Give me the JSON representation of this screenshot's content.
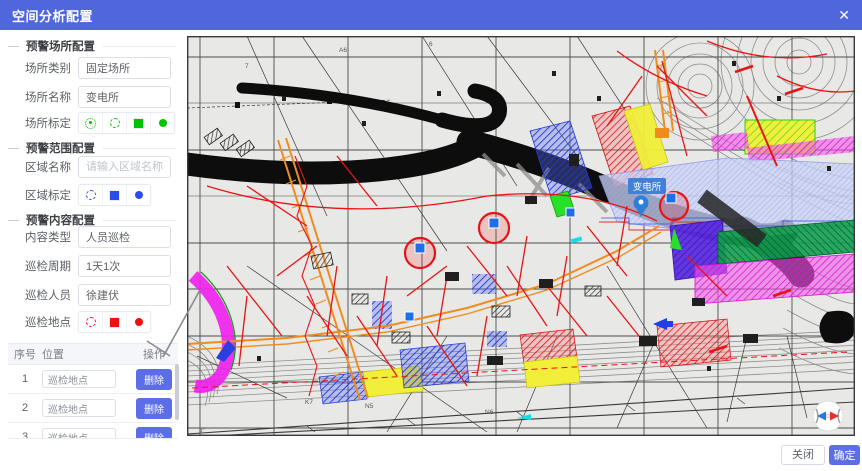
{
  "header": {
    "title": "空间分析配置",
    "close_icon": "✕"
  },
  "panel": {
    "sections": [
      {
        "title": "预警场所配置"
      },
      {
        "title": "预警范围配置"
      },
      {
        "title": "预警内容配置"
      }
    ],
    "fields": {
      "place_type": {
        "label": "场所类别",
        "value": "固定场所"
      },
      "place_name": {
        "label": "场所名称",
        "value": "变电所"
      },
      "place_mark": {
        "label": "场所标定"
      },
      "area_name": {
        "label": "区域名称",
        "placeholder": "请输入区域名称"
      },
      "area_mark": {
        "label": "区域标定"
      },
      "content_type": {
        "label": "内容类型",
        "value": "人员巡检"
      },
      "patrol_cycle": {
        "label": "巡检周期",
        "value": "1天1次"
      },
      "patrol_person": {
        "label": "巡检人员",
        "value": "徐建伏"
      },
      "patrol_point": {
        "label": "巡检地点"
      }
    },
    "table": {
      "headers": {
        "index": "序号",
        "location": "位置",
        "action": "操作"
      },
      "rows": [
        {
          "index": "1",
          "location": "巡检地点",
          "action": "删除"
        },
        {
          "index": "2",
          "location": "巡检地点",
          "action": "删除"
        },
        {
          "index": "3",
          "location": "巡检地点",
          "action": "删除"
        }
      ]
    }
  },
  "map": {
    "substation_label": "变电所",
    "annotations": [
      "A6",
      "6",
      "7",
      "K7",
      "N5",
      "N6",
      "3°"
    ]
  },
  "footer": {
    "close_label": "关闭",
    "confirm_label": "确定"
  },
  "colors": {
    "accent_blue": "#5066dd",
    "button_blue": "#5b6ee8",
    "marker_green": "#00c300",
    "marker_blue": "#2b4be8",
    "marker_red": "#f01010",
    "substation_tag_blue": "#3f80d8"
  }
}
